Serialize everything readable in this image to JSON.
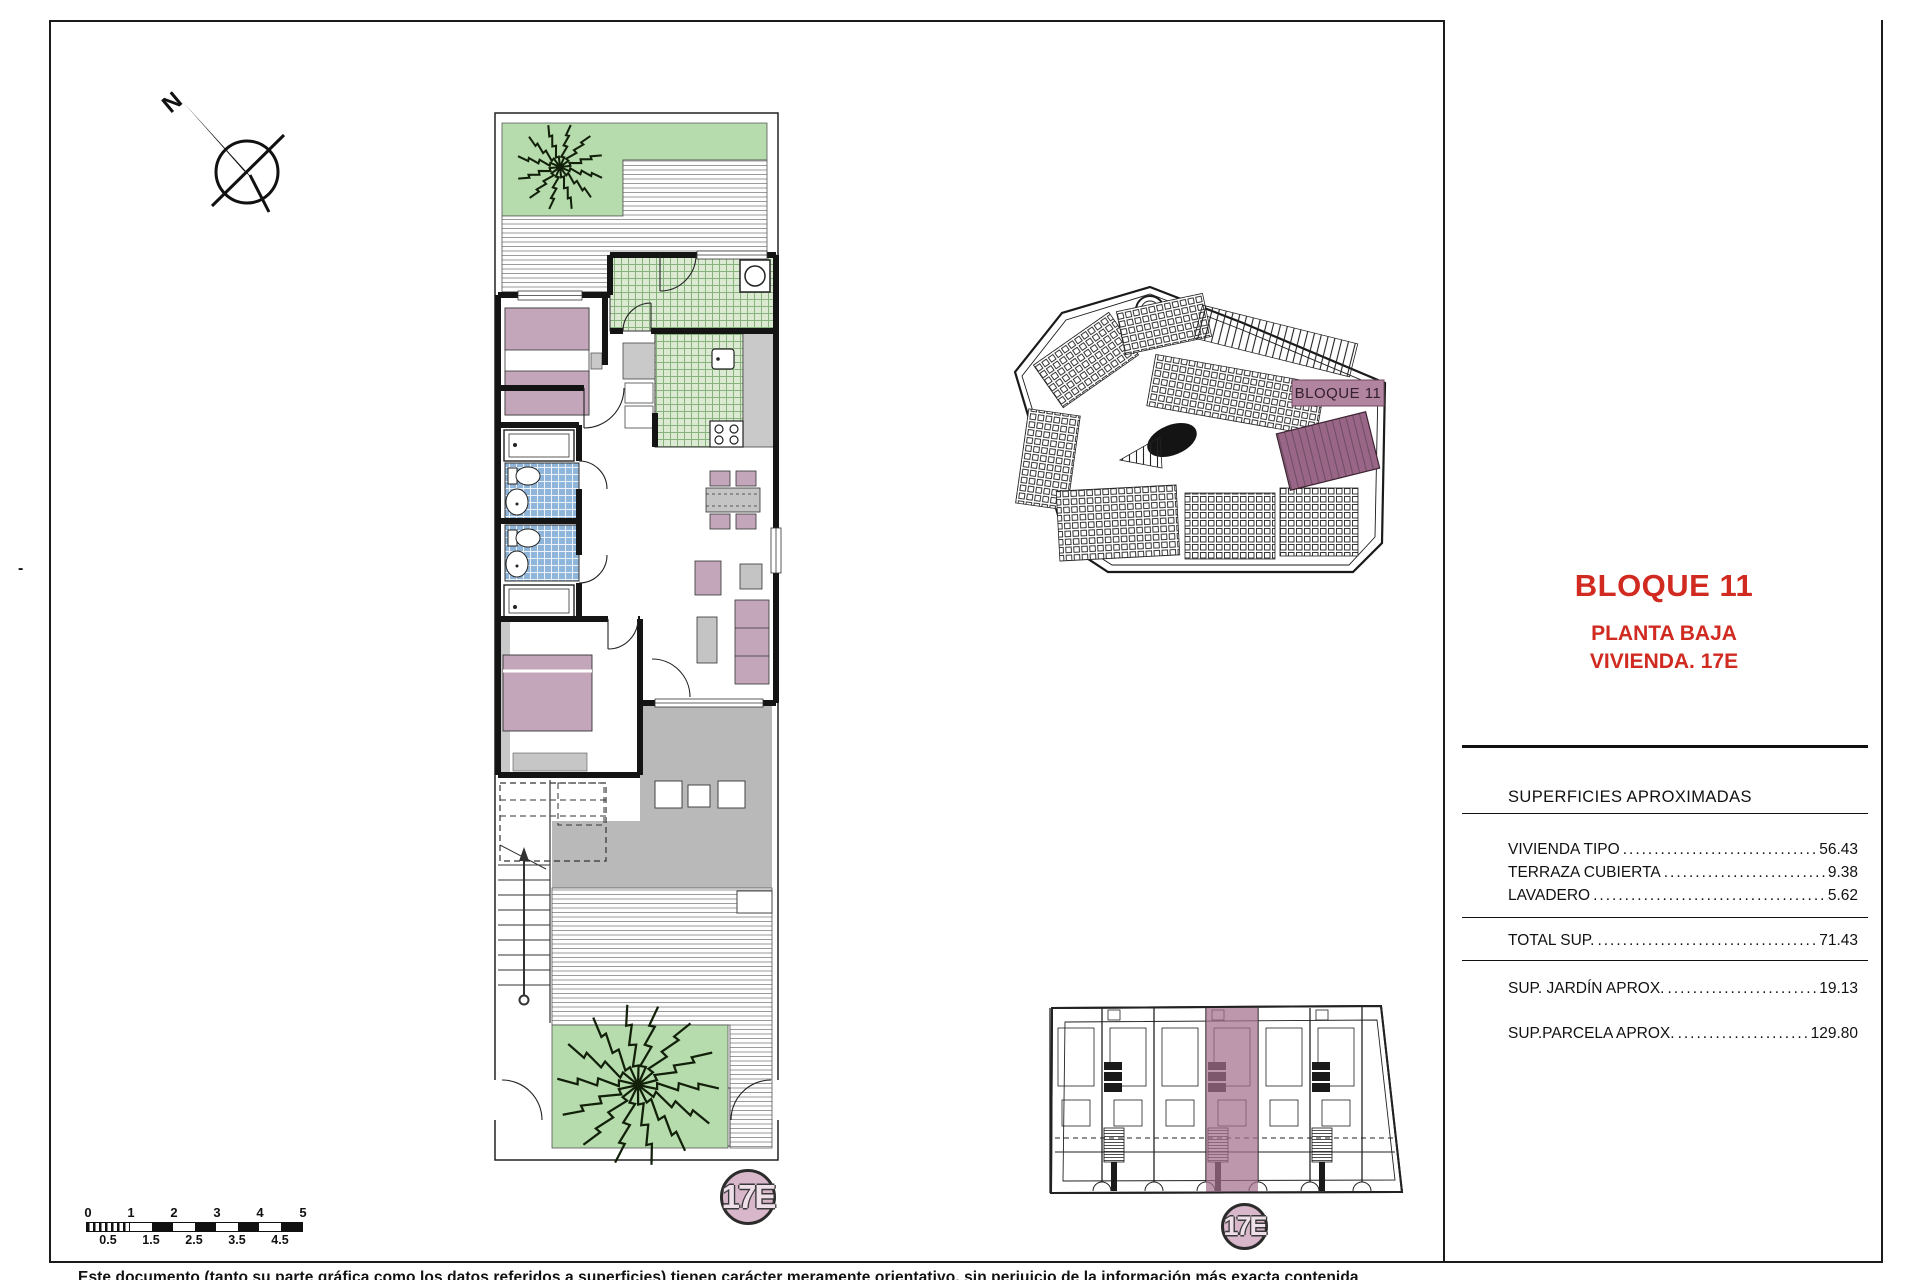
{
  "title_block": {
    "title": "BLOQUE 11",
    "line1": "PLANTA BAJA",
    "line2": "VIVIENDA. 17E"
  },
  "areas_table": {
    "heading": "SUPERFICIES APROXIMADAS",
    "rows": [
      {
        "label": "VIVIENDA TIPO",
        "leader": "........................................",
        "value": "56.43"
      },
      {
        "label": "TERRAZA CUBIERTA",
        "leader": "....................................",
        "value": "9.38"
      },
      {
        "label": "LAVADERO",
        "leader": "................................................",
        "value": "5.62"
      },
      {
        "label": "TOTAL SUP.",
        "leader": "............................................",
        "value": "71.43"
      },
      {
        "label": "SUP. JARDÍN APROX.",
        "leader": "..................................",
        "value": "19.13"
      },
      {
        "label": "SUP.PARCELA APROX.",
        "leader": "..............................",
        "value": "129.80"
      }
    ]
  },
  "site_plan": {
    "block_label": "BLOQUE 11"
  },
  "unit_badges": {
    "floorplan": "17E",
    "blockplan": "17E"
  },
  "compass": {
    "label": "N"
  },
  "scale_bar": {
    "top_labels": [
      "0",
      "1",
      "2",
      "3",
      "4",
      "5"
    ],
    "bottom_labels": [
      "0.5",
      "1.5",
      "2.5",
      "3.5",
      "4.5"
    ]
  },
  "disclaimer": "Este documento (tanto su parte gráfica como los datos referidos a superficies) tienen carácter meramente orientativo, sin perjuicio de la información más exacta contenida",
  "fold_mark": "-",
  "colors": {
    "accent_red": "#d02a21",
    "furniture_pink": "#c4a6ba",
    "tile_blue": "#8fb6da",
    "tile_green": "#dcead4",
    "garden_green": "#b6dcad",
    "terrace_gray": "#b9b9b9",
    "highlight_mauve": "#a4708c",
    "label_mauve": "#b1849f",
    "badge_pink": "#d8b7cb"
  }
}
